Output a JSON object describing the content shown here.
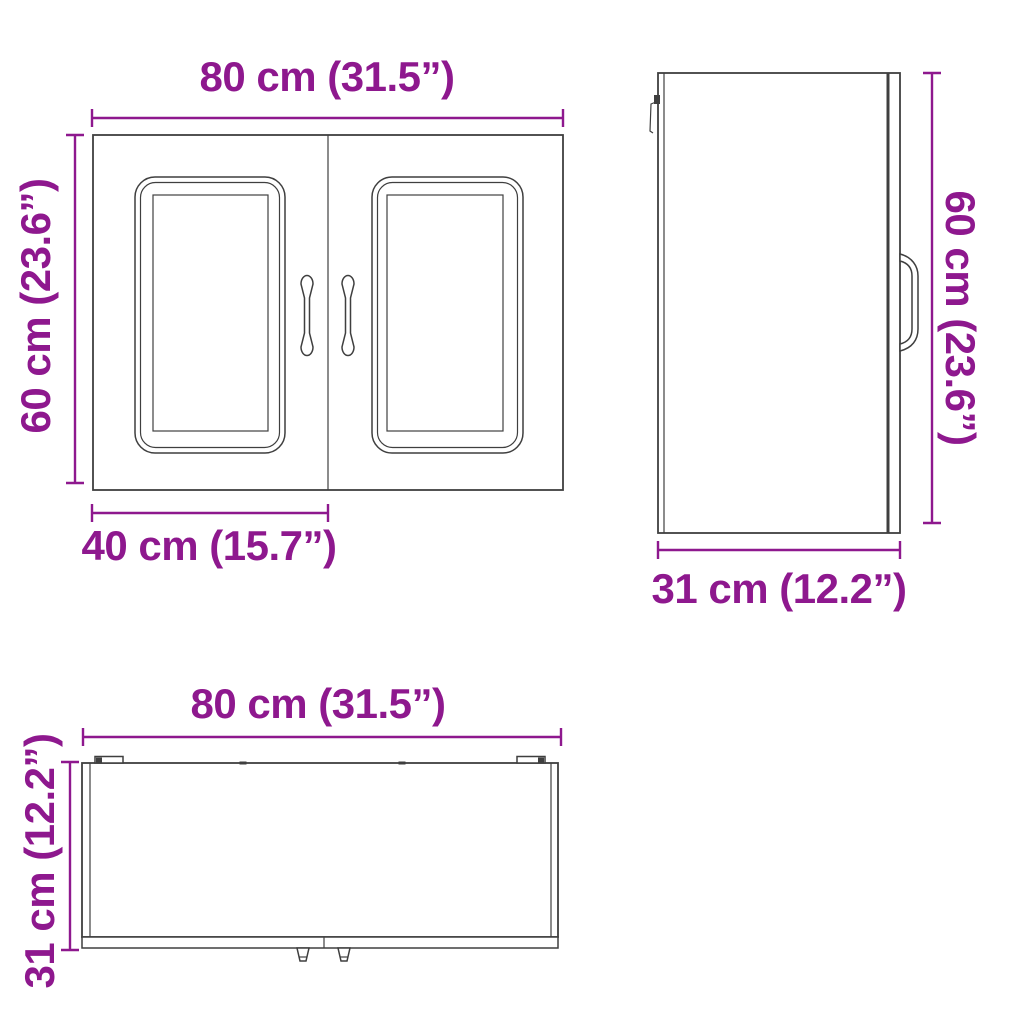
{
  "colors": {
    "accent": "#8E188E",
    "line": "#3F3F3F"
  },
  "views": {
    "front": {
      "width_label": "80 cm (31.5”)",
      "height_label": "60 cm (23.6”)",
      "door_width_label": "40 cm (15.7”)"
    },
    "side": {
      "height_label": "60 cm (23.6”)",
      "depth_label": "31 cm (12.2”)"
    },
    "top": {
      "width_label": "80 cm (31.5”)",
      "depth_label": "31 cm (12.2”)"
    }
  }
}
